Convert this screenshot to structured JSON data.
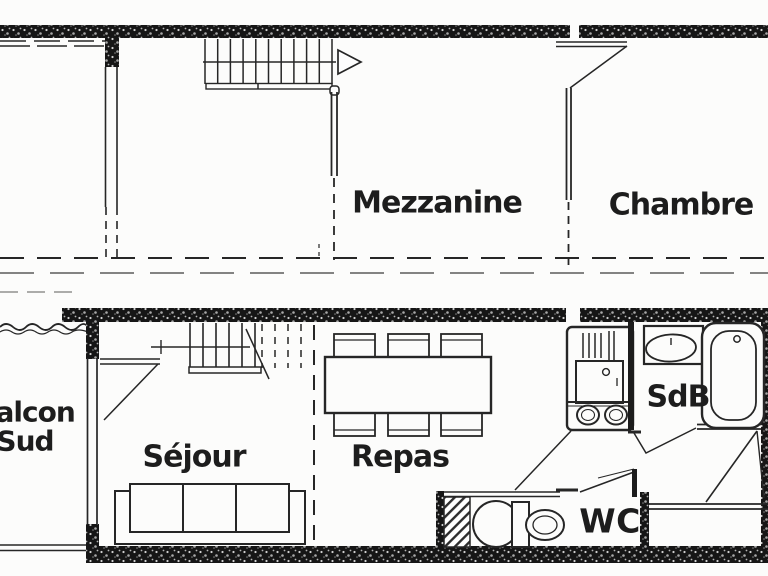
{
  "diagram_type": "apartment-floor-plan",
  "levels": {
    "upper": {
      "rooms": [
        "Mezzanine",
        "Chambre"
      ],
      "features": [
        "staircase-with-up-arrow",
        "door-to-chambre",
        "open-edge-dashed"
      ]
    },
    "lower": {
      "rooms": [
        "Balcon Sud",
        "Séjour",
        "Repas",
        "SdB",
        "WC"
      ],
      "features": [
        "staircase",
        "sofa",
        "dining-table-6-chairs",
        "kitchen-unit",
        "bathroom-sink",
        "bathtub",
        "toilet",
        "service-shaft",
        "entrance-door"
      ]
    }
  },
  "labels": {
    "mezzanine": "Mezzanine",
    "chambre": "Chambre",
    "balcon_line1": "Balcon",
    "balcon_line2": "Sud",
    "sejour": "Séjour",
    "repas": "Repas",
    "sdb": "SdB",
    "wc": "WC"
  },
  "colors": {
    "ink": "#262626",
    "wall_fill": "#161616",
    "paper": "#fcfcfb",
    "text": "#1d1d1d"
  }
}
